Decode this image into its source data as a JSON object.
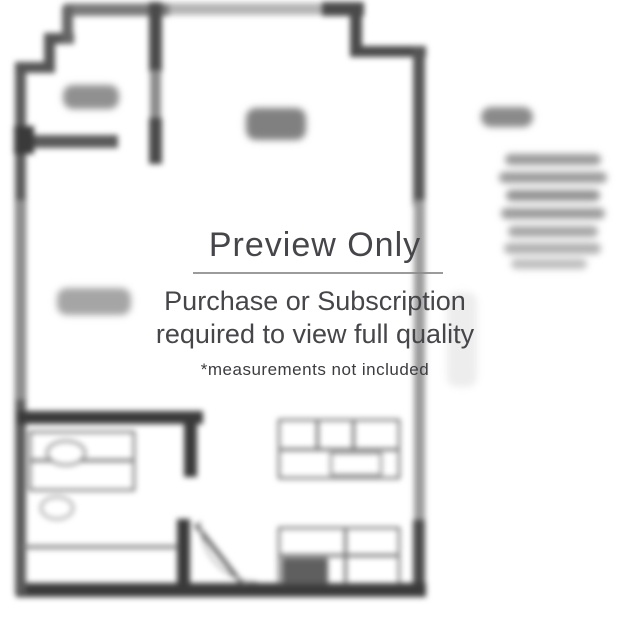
{
  "watermark": {
    "title": "Preview Only",
    "subtitle_line1": "Purchase or Subscription",
    "subtitle_line2": "required to view full quality",
    "footnote": "*measurements not included"
  },
  "colors": {
    "background": "#ffffff",
    "wall_dark": "#3a3a3a",
    "wall_medium": "#5a5a5a",
    "wall_faded": "#9a9a9a",
    "fixture_outline": "#4f4f4f",
    "label_blob": "#8f8f8f",
    "watermark_text": "#45454a",
    "watermark_divider": "#8a8a8a"
  },
  "floorplan": {
    "description": "blurred studio apartment floor plan preview with illegible room labels and side text",
    "elements": [
      {
        "name": "top-wall",
        "kind": "rect",
        "x": 64,
        "y": 3,
        "w": 300,
        "h": 12,
        "color": "#b5b5b5"
      },
      {
        "name": "top-wall-left-seg",
        "kind": "rect",
        "x": 64,
        "y": 4,
        "w": 105,
        "h": 12,
        "color": "#7a7a7a"
      },
      {
        "name": "top-wall-right-seg",
        "kind": "rect",
        "x": 322,
        "y": 2,
        "w": 42,
        "h": 14,
        "color": "#4a4a4a"
      },
      {
        "name": "topright-step-vertical",
        "kind": "rect",
        "x": 350,
        "y": 2,
        "w": 12,
        "h": 54,
        "color": "#4a4a4a"
      },
      {
        "name": "topright-step-horizontal",
        "kind": "rect",
        "x": 350,
        "y": 46,
        "w": 76,
        "h": 11,
        "color": "#4a4a4a"
      },
      {
        "name": "right-wall-top",
        "kind": "rect",
        "x": 413,
        "y": 46,
        "w": 12,
        "h": 160,
        "color": "#555555"
      },
      {
        "name": "right-wall-middle",
        "kind": "rect",
        "x": 414,
        "y": 200,
        "w": 11,
        "h": 330,
        "color": "#9a9a9a"
      },
      {
        "name": "right-wall-bottom",
        "kind": "rect",
        "x": 413,
        "y": 520,
        "w": 12,
        "h": 76,
        "color": "#4a4a4a"
      },
      {
        "name": "bottom-wall",
        "kind": "rect",
        "x": 16,
        "y": 583,
        "w": 410,
        "h": 14,
        "color": "#3a3a3a"
      },
      {
        "name": "left-wall",
        "kind": "rect",
        "x": 15,
        "y": 64,
        "w": 11,
        "h": 530,
        "color": "#5a5a5a"
      },
      {
        "name": "left-wall-fade",
        "kind": "rect",
        "x": 16,
        "y": 200,
        "w": 9,
        "h": 200,
        "color": "#8f8f8f"
      },
      {
        "name": "topleft-step-h1",
        "kind": "rect",
        "x": 15,
        "y": 62,
        "w": 40,
        "h": 11,
        "color": "#555555"
      },
      {
        "name": "topleft-step-v1",
        "kind": "rect",
        "x": 44,
        "y": 34,
        "w": 11,
        "h": 38,
        "color": "#555555"
      },
      {
        "name": "topleft-step-h2",
        "kind": "rect",
        "x": 44,
        "y": 33,
        "w": 30,
        "h": 11,
        "color": "#555555"
      },
      {
        "name": "topleft-step-v2",
        "kind": "rect",
        "x": 62,
        "y": 6,
        "w": 11,
        "h": 38,
        "color": "#666666"
      },
      {
        "name": "entry-wall-top",
        "kind": "rect",
        "x": 149,
        "y": 2,
        "w": 13,
        "h": 70,
        "color": "#4a4a4a"
      },
      {
        "name": "entry-wall-mid",
        "kind": "rect",
        "x": 150,
        "y": 70,
        "w": 11,
        "h": 50,
        "color": "#8a8a8a"
      },
      {
        "name": "entry-wall-bottom",
        "kind": "rect",
        "x": 149,
        "y": 118,
        "w": 13,
        "h": 46,
        "color": "#4a4a4a"
      },
      {
        "name": "closet-wall",
        "kind": "rect",
        "x": 20,
        "y": 135,
        "w": 98,
        "h": 13,
        "color": "#5a5a5a"
      },
      {
        "name": "wall-knob",
        "kind": "rect",
        "x": 14,
        "y": 126,
        "w": 20,
        "h": 28,
        "color": "#3a3a3a"
      },
      {
        "name": "mid-wall",
        "kind": "rect",
        "x": 17,
        "y": 411,
        "w": 186,
        "h": 13,
        "color": "#3a3a3a"
      },
      {
        "name": "bath-wall-top",
        "kind": "rect",
        "x": 184,
        "y": 411,
        "w": 13,
        "h": 66,
        "color": "#3a3a3a"
      },
      {
        "name": "bath-wall-bottom",
        "kind": "rect",
        "x": 177,
        "y": 519,
        "w": 13,
        "h": 72,
        "color": "#3a3a3a"
      },
      {
        "name": "bath-divider-line",
        "kind": "line",
        "x": 23,
        "y": 545,
        "w": 155,
        "h": 4,
        "color": "#8a8a8a"
      },
      {
        "name": "bath-vanity",
        "kind": "outline",
        "x": 29,
        "y": 431,
        "w": 106,
        "h": 60,
        "color": "#4f4f4f"
      },
      {
        "name": "bath-vanity-line",
        "kind": "line",
        "x": 29,
        "y": 459,
        "w": 106,
        "h": 3,
        "color": "#6a6a6a"
      },
      {
        "name": "bath-sink",
        "kind": "ellipse",
        "x": 46,
        "y": 440,
        "w": 40,
        "h": 26,
        "color": "#6a6a6a"
      },
      {
        "name": "bath-toilet",
        "kind": "ellipse",
        "x": 40,
        "y": 496,
        "w": 34,
        "h": 24,
        "color": "#8a8a8a"
      },
      {
        "name": "kitchen-top-counter",
        "kind": "outline",
        "x": 278,
        "y": 419,
        "w": 122,
        "h": 60,
        "color": "#4f4f4f"
      },
      {
        "name": "kitchen-top-counter-line",
        "kind": "line",
        "x": 278,
        "y": 448,
        "w": 122,
        "h": 3,
        "color": "#6a6a6a"
      },
      {
        "name": "kitchen-top-divider1",
        "kind": "line",
        "x": 316,
        "y": 419,
        "w": 3,
        "h": 30,
        "color": "#6a6a6a"
      },
      {
        "name": "kitchen-top-divider2",
        "kind": "line",
        "x": 352,
        "y": 419,
        "w": 3,
        "h": 30,
        "color": "#6a6a6a"
      },
      {
        "name": "kitchen-appliance",
        "kind": "outline",
        "x": 330,
        "y": 452,
        "w": 52,
        "h": 24,
        "color": "#777777"
      },
      {
        "name": "kitchen-bottom-counter",
        "kind": "outline",
        "x": 278,
        "y": 527,
        "w": 122,
        "h": 58,
        "color": "#4f4f4f"
      },
      {
        "name": "kitchen-bottom-counter-line",
        "kind": "line",
        "x": 278,
        "y": 554,
        "w": 122,
        "h": 3,
        "color": "#6a6a6a"
      },
      {
        "name": "kitchen-bottom-block",
        "kind": "rect",
        "x": 282,
        "y": 558,
        "w": 46,
        "h": 25,
        "color": "#5f5f5f"
      },
      {
        "name": "kitchen-bottom-divider",
        "kind": "line",
        "x": 344,
        "y": 527,
        "w": 3,
        "h": 58,
        "color": "#6a6a6a"
      },
      {
        "name": "bath-door-leaf",
        "kind": "diag",
        "x": 197,
        "y": 523,
        "len": 78,
        "t": 4,
        "rot": 52,
        "color": "#555555"
      },
      {
        "name": "bath-door-arc",
        "kind": "arc",
        "x": 199,
        "y": 521,
        "w": 58,
        "h": 62,
        "color": "#aaaaaa"
      },
      {
        "name": "closet-label-blob",
        "kind": "blob",
        "x": 63,
        "y": 85,
        "w": 56,
        "h": 24,
        "color": "#909090"
      },
      {
        "name": "living-label-blob",
        "kind": "blob",
        "x": 246,
        "y": 108,
        "w": 60,
        "h": 32,
        "color": "#808080"
      },
      {
        "name": "room-label-blob",
        "kind": "blob",
        "x": 57,
        "y": 288,
        "w": 74,
        "h": 27,
        "color": "#a5a5a5"
      },
      {
        "name": "side-title-blob",
        "kind": "blob",
        "x": 481,
        "y": 107,
        "w": 52,
        "h": 20,
        "color": "#8a8a8a"
      },
      {
        "name": "side-text-line-1",
        "kind": "blob",
        "x": 505,
        "y": 154,
        "w": 96,
        "h": 11,
        "color": "#989898"
      },
      {
        "name": "side-text-line-2",
        "kind": "blob",
        "x": 499,
        "y": 172,
        "w": 108,
        "h": 11,
        "color": "#9a9a9a"
      },
      {
        "name": "side-text-line-3",
        "kind": "blob",
        "x": 506,
        "y": 190,
        "w": 94,
        "h": 11,
        "color": "#909090"
      },
      {
        "name": "side-text-line-4",
        "kind": "blob",
        "x": 501,
        "y": 208,
        "w": 104,
        "h": 11,
        "color": "#9a9a9a"
      },
      {
        "name": "side-text-line-5",
        "kind": "blob",
        "x": 508,
        "y": 226,
        "w": 90,
        "h": 11,
        "color": "#a5a5a5"
      },
      {
        "name": "side-text-line-6",
        "kind": "blob",
        "x": 504,
        "y": 243,
        "w": 97,
        "h": 11,
        "color": "#b0b0b0"
      },
      {
        "name": "side-text-line-7",
        "kind": "blob",
        "x": 511,
        "y": 259,
        "w": 76,
        "h": 10,
        "color": "#bcbcbc"
      },
      {
        "name": "side-faint-smudge",
        "kind": "blob",
        "x": 447,
        "y": 292,
        "w": 30,
        "h": 95,
        "color": "#ededed"
      }
    ]
  }
}
